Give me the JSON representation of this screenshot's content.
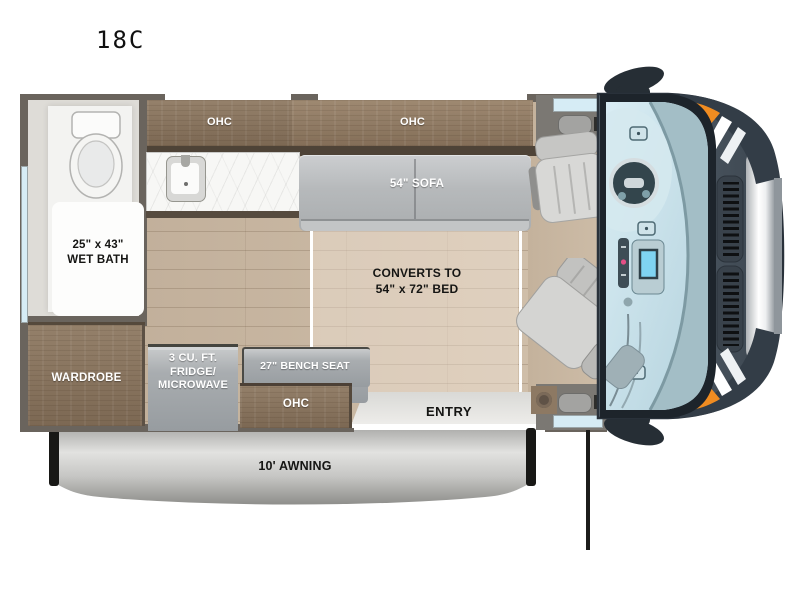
{
  "title": "18C",
  "rooms": {
    "wet_bath": {
      "line1": "25\" x 43\"",
      "line2": "WET BATH"
    },
    "wardrobe": {
      "label": "WARDROBE"
    },
    "galley": {
      "ohc_left": "OHC",
      "ohc_right": "OHC",
      "ohc_bottom": "OHC",
      "fridge": {
        "line1": "3 CU. FT.",
        "line2": "FRIDGE/",
        "line3": "MICROWAVE"
      }
    },
    "living": {
      "sofa": "54\" SOFA",
      "bed_line1": "CONVERTS TO",
      "bed_line2": "54\" x 72\" BED",
      "bench": "27\" BENCH SEAT"
    },
    "entry": {
      "label": "ENTRY"
    },
    "exterior": {
      "awning": "10' AWNING"
    }
  },
  "colors": {
    "wood_cabinet": "#8a7460",
    "wood_dark_edge": "#4e4337",
    "floor_plank": "#c9b8a3",
    "wall": "#6a645d",
    "furniture_gray": "#a7abae",
    "window_blue": "#d6ecf5",
    "windshield_glass": "#c3dde7",
    "van_body": "#46525d",
    "accent_orange": "#f08c21",
    "label_light": "#ffffff",
    "label_dark": "#151513"
  }
}
